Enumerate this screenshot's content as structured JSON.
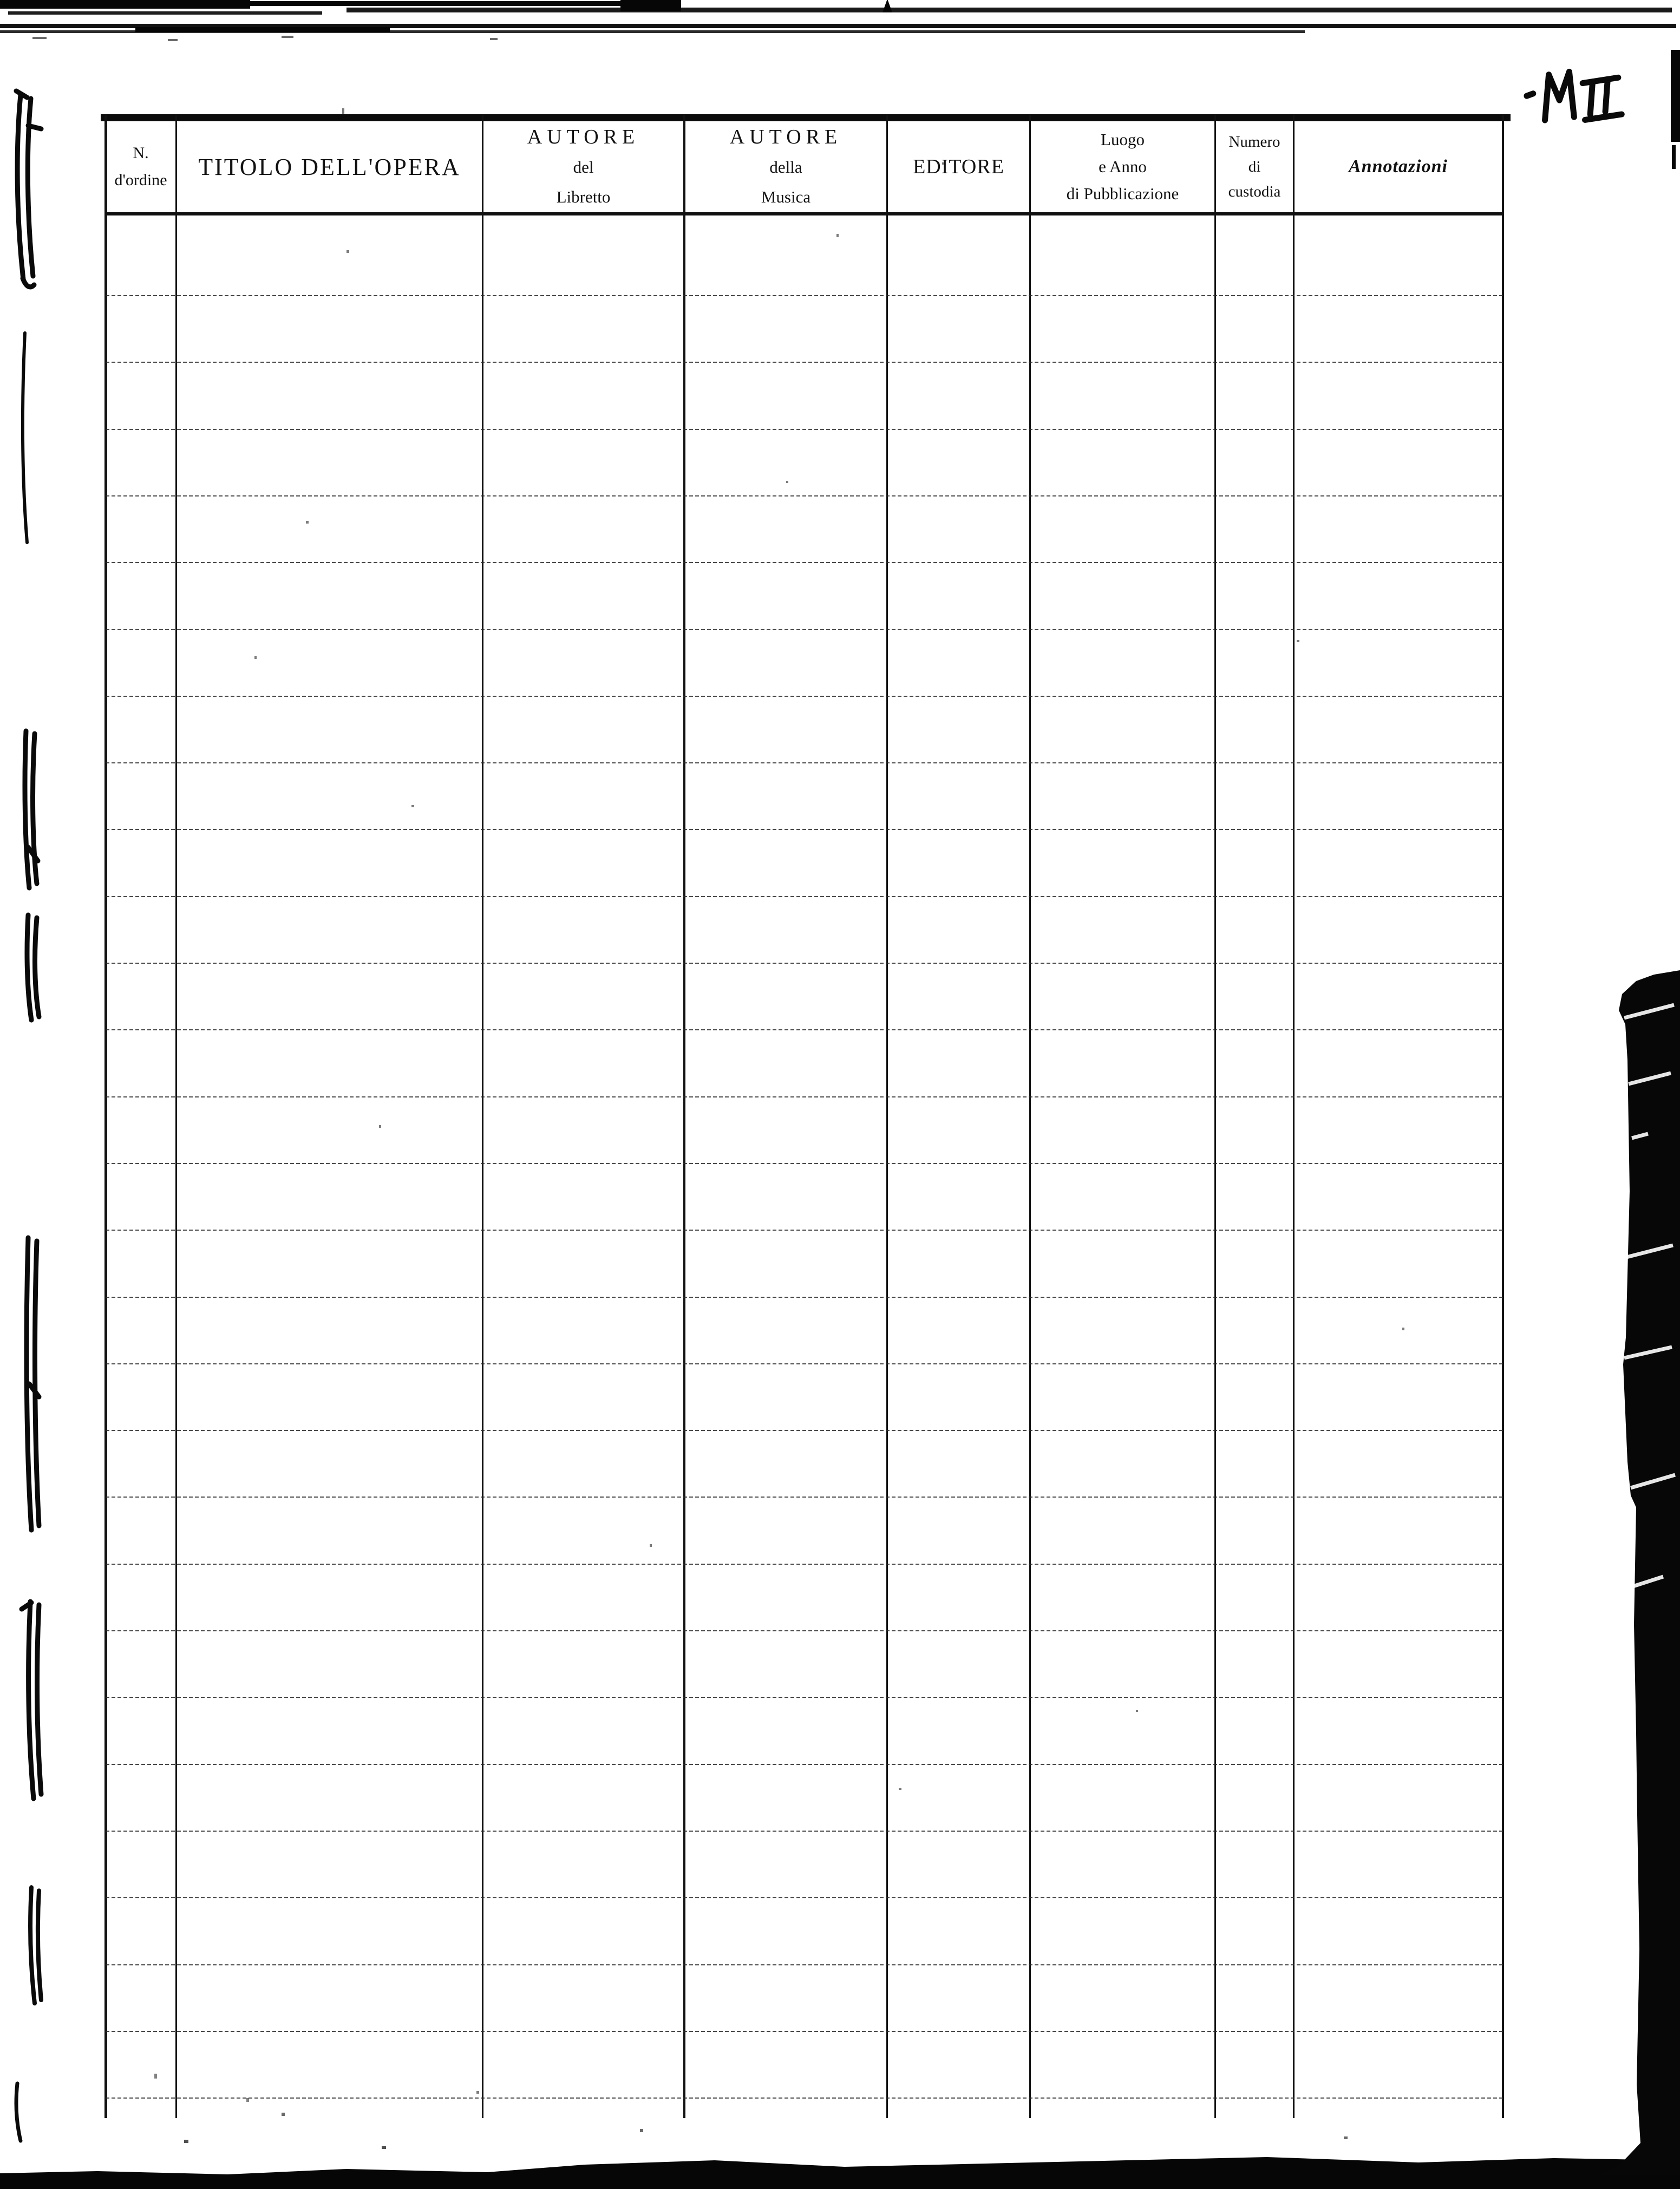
{
  "page": {
    "handwritten_mark": "M II",
    "paper_color": "#ffffff",
    "ink_color": "#101010"
  },
  "table": {
    "ruled_row_count": 28,
    "columns": [
      {
        "id": "n-ordine",
        "header_lines": [
          "N.",
          "d'ordine"
        ]
      },
      {
        "id": "titolo-opera",
        "header_lines": [
          "TITOLO DELL'OPERA"
        ]
      },
      {
        "id": "autore-libretto",
        "header_lines": [
          "AUTORE",
          "del",
          "Libretto"
        ]
      },
      {
        "id": "autore-musica",
        "header_lines": [
          "AUTORE",
          "della",
          "Musica"
        ]
      },
      {
        "id": "editore",
        "header_lines": [
          "EDITORE"
        ]
      },
      {
        "id": "luogo-pubblicazione",
        "header_lines": [
          "Luogo",
          "e Anno",
          "di Pubblicazione"
        ]
      },
      {
        "id": "numero-custodia",
        "header_lines": [
          "Numero",
          "di",
          "custodia"
        ]
      },
      {
        "id": "annotazioni",
        "header_lines": [
          "Annotazioni"
        ]
      }
    ]
  }
}
